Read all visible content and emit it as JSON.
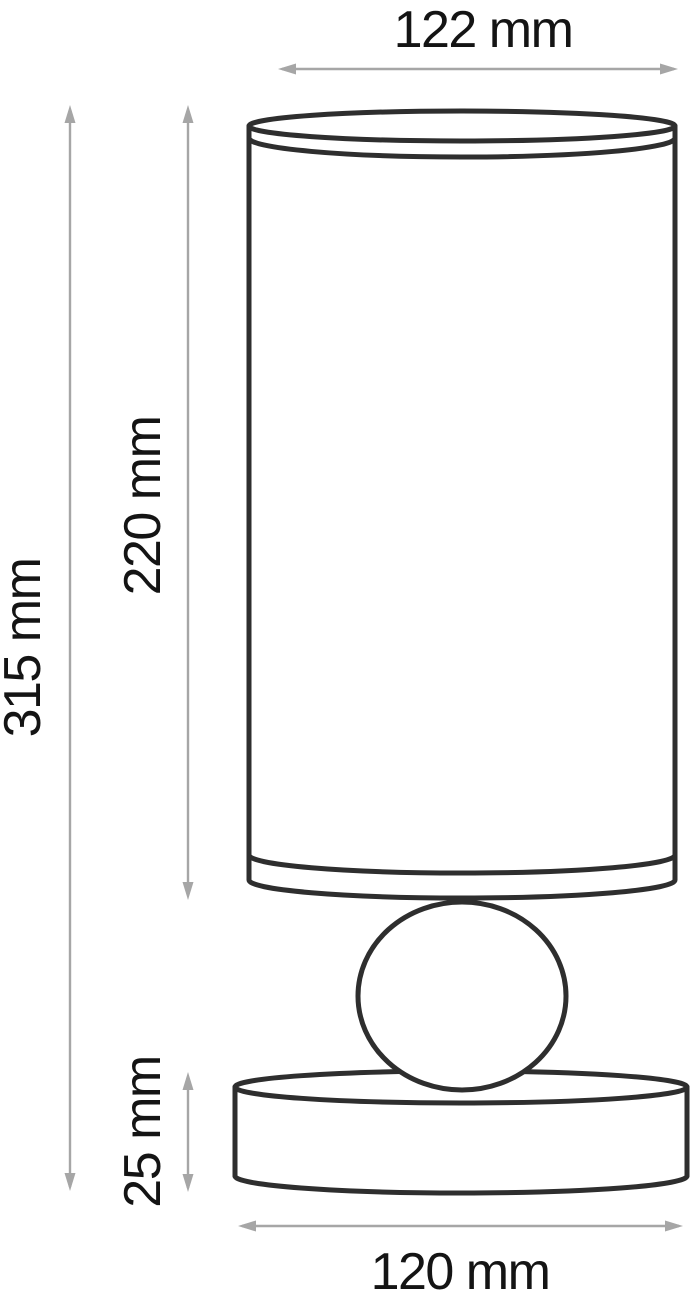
{
  "subject": "Table lamp technical dimension drawing",
  "colors": {
    "outline": "#2e2e2e",
    "dimension": "#a6a6a6",
    "text": "#141414",
    "background": "#ffffff"
  },
  "dimensions": {
    "shade_diameter": {
      "label": "122 mm",
      "value": 122,
      "unit": "mm",
      "orientation": "horizontal-top"
    },
    "total_height": {
      "label": "315 mm",
      "value": 315,
      "unit": "mm",
      "orientation": "vertical-left-outer"
    },
    "shade_height": {
      "label": "220 mm",
      "value": 220,
      "unit": "mm",
      "orientation": "vertical-left-inner"
    },
    "base_height": {
      "label": "25 mm",
      "value": 25,
      "unit": "mm",
      "orientation": "vertical-left-inner"
    },
    "base_diameter": {
      "label": "120 mm",
      "value": 120,
      "unit": "mm",
      "orientation": "horizontal-bottom"
    }
  }
}
